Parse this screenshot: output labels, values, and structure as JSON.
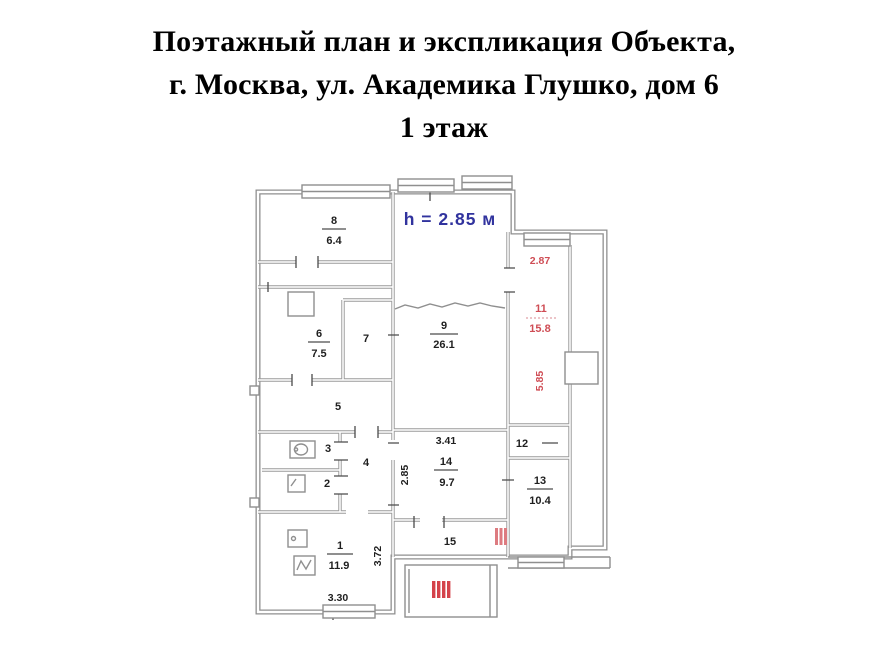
{
  "page": {
    "title_line1": "Поэтажный план и экспликация Объекта,",
    "title_line2": "г. Москва, ул. Академика Глушко, дом 6",
    "title_line3": "1 этаж"
  },
  "plan": {
    "height_note": "h = 2.85 м",
    "colors": {
      "red_label": "#cf4d55",
      "blue_label": "#31339e",
      "wall_gray": "#8f8f8f",
      "text_black": "#1f1f1f",
      "hatch_red": "#d4424a"
    },
    "rooms": {
      "1": {
        "num": "1",
        "area": "11.9"
      },
      "2": {
        "num": "2"
      },
      "3": {
        "num": "3"
      },
      "4": {
        "num": "4"
      },
      "5": {
        "num": "5"
      },
      "6": {
        "num": "6",
        "area": "7.5"
      },
      "7": {
        "num": "7"
      },
      "8": {
        "num": "8",
        "area": "6.4"
      },
      "9": {
        "num": "9",
        "area": "26.1"
      },
      "11": {
        "num": "11",
        "area": "15.8"
      },
      "12": {
        "num": "12"
      },
      "13": {
        "num": "13",
        "area": "10.4"
      },
      "14": {
        "num": "14",
        "area": "9.7"
      },
      "15": {
        "num": "15"
      }
    },
    "dims": {
      "r1_bottom": "3.30",
      "r1_side": "3.72",
      "r14_top": "3.41",
      "r14_side": "2.85",
      "r11_top": "2.87",
      "r11_side": "5.85"
    }
  }
}
